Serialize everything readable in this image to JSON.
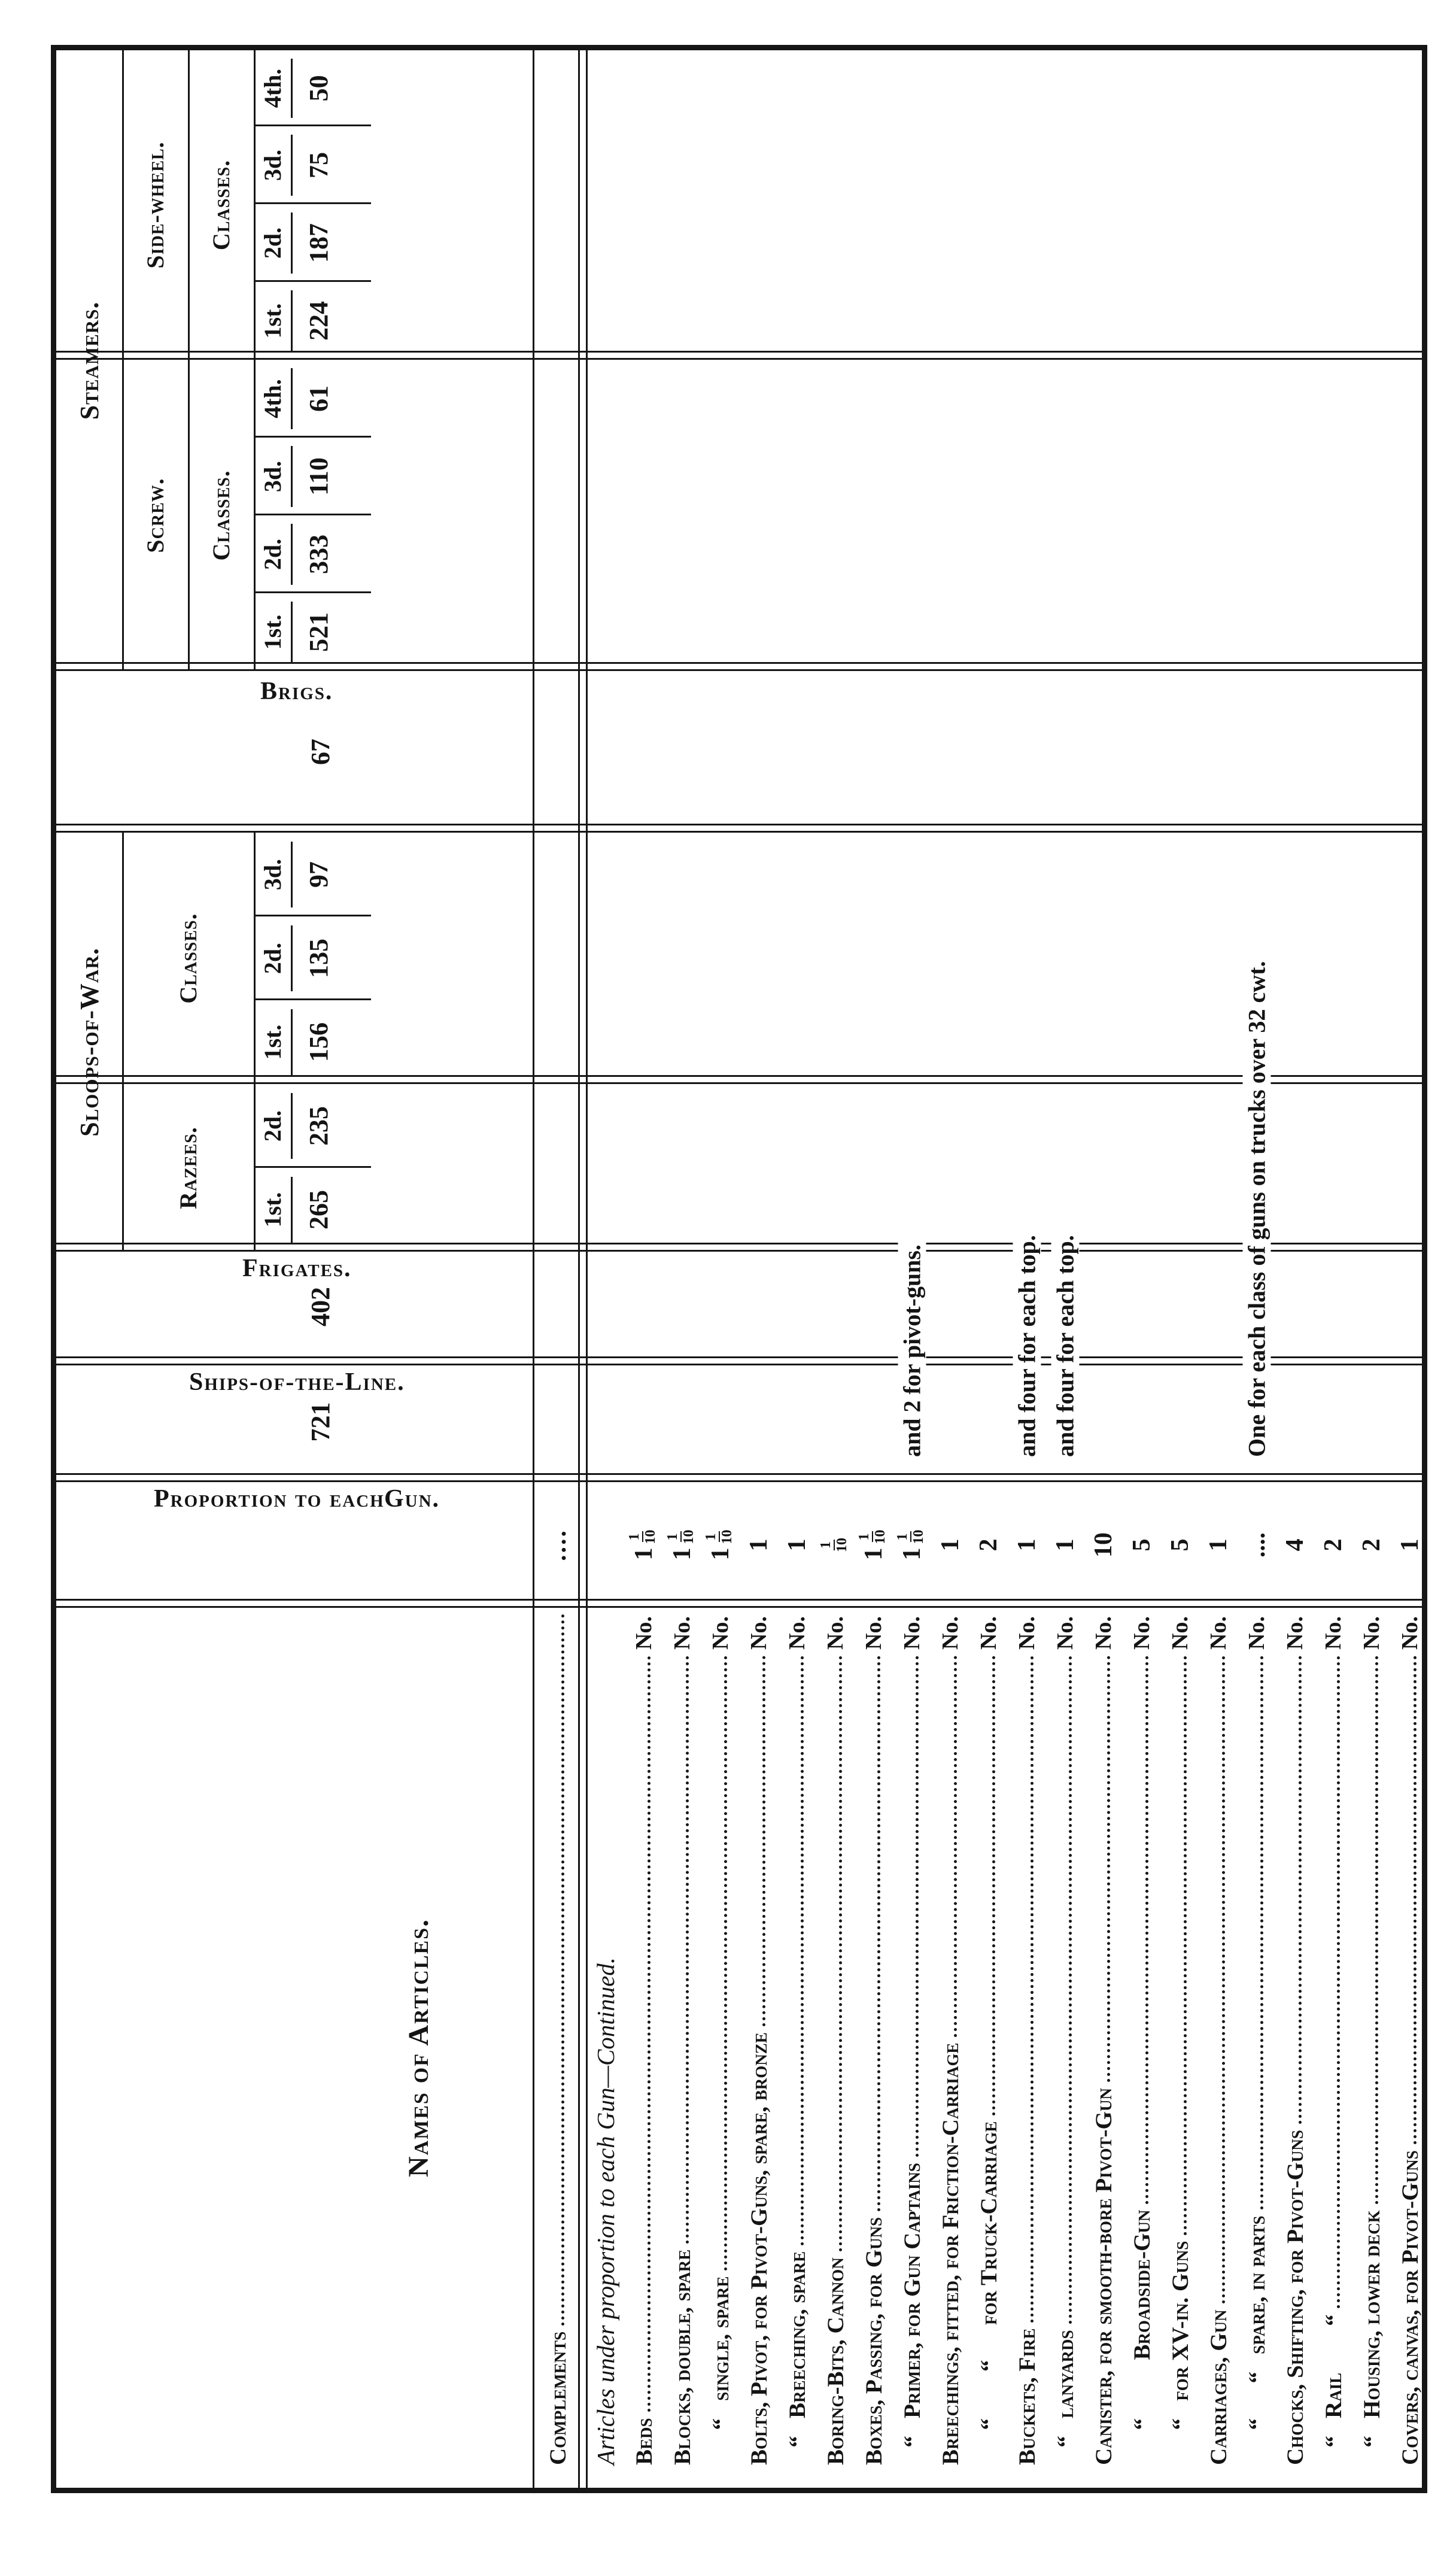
{
  "table": {
    "names_header": "Names of Articles.",
    "proportion": {
      "label1": "Proportion to each",
      "label2": "Gun.",
      "value_dots": "...."
    },
    "ships_of_the_line": {
      "label": "Ships-of-the-Line.",
      "complement": "721"
    },
    "frigates": {
      "label": "Frigates.",
      "complement": "402"
    },
    "sloops": {
      "label": "Sloops-of-War.",
      "razees": {
        "label": "Razees.",
        "cols": [
          {
            "label": "1st.",
            "complement": "265"
          },
          {
            "label": "2d.",
            "complement": "235"
          }
        ]
      },
      "classes": {
        "label": "Classes.",
        "cols": [
          {
            "label": "1st.",
            "complement": "156"
          },
          {
            "label": "2d.",
            "complement": "135"
          },
          {
            "label": "3d.",
            "complement": "97"
          }
        ]
      }
    },
    "brigs": {
      "label": "Brigs.",
      "complement": "67"
    },
    "steamers": {
      "label": "Steamers.",
      "screw": {
        "label": "Screw.",
        "classes_label": "Classes.",
        "cols": [
          {
            "label": "1st.",
            "complement": "521"
          },
          {
            "label": "2d.",
            "complement": "333"
          },
          {
            "label": "3d.",
            "complement": "110"
          },
          {
            "label": "4th.",
            "complement": "61"
          }
        ]
      },
      "side_wheel": {
        "label": "Side-wheel.",
        "classes_label": "Classes.",
        "cols": [
          {
            "label": "1st.",
            "complement": "224"
          },
          {
            "label": "2d.",
            "complement": "187"
          },
          {
            "label": "3d.",
            "complement": "75"
          },
          {
            "label": "4th.",
            "complement": "50"
          }
        ]
      }
    },
    "complements_row": {
      "label": "Complements",
      "value_dots": "...."
    },
    "rows": [
      {
        "style": "italic",
        "name": "Articles under proportion to each Gun—Continued."
      },
      {
        "name": "Beds",
        "no": "No.",
        "value": {
          "whole": "1",
          "num": "1",
          "den": "10"
        }
      },
      {
        "name": "Blocks, double, spare",
        "no": "No.",
        "value": {
          "whole": "1",
          "num": "1",
          "den": "10"
        }
      },
      {
        "name": "      “   single, spare",
        "no": "No.",
        "value": {
          "whole": "1",
          "num": "1",
          "den": "10"
        }
      },
      {
        "name": "Bolts, Pivot, for Pivot-Guns, spare, bronze",
        "no": "No.",
        "value": {
          "whole": "1"
        }
      },
      {
        "name": "   “   Breeching, spare",
        "no": "No.",
        "value": {
          "whole": "1"
        }
      },
      {
        "name": "Boring-Bits, Cannon",
        "no": "No.",
        "value": {
          "num": "1",
          "den": "10"
        }
      },
      {
        "name": "Boxes, Passing, for Guns",
        "no": "No.",
        "value": {
          "whole": "1",
          "num": "1",
          "den": "10"
        }
      },
      {
        "name": "   “   Primer, for Gun Captains",
        "no": "No.",
        "value": {
          "whole": "1",
          "num": "1",
          "den": "10"
        },
        "note": "and 2 for pivot-guns."
      },
      {
        "name": "Breechings, fitted, for Friction-Carriage",
        "no": "No.",
        "value": {
          "whole": "1"
        }
      },
      {
        "name": "      “        “      for Truck-Carriage",
        "no": "No.",
        "value": {
          "whole": "2"
        }
      },
      {
        "name": "Buckets, Fire",
        "no": "No.",
        "value": {
          "whole": "1"
        },
        "note": "and four for each top."
      },
      {
        "name": "   “   lanyards",
        "no": "No.",
        "value": {
          "whole": "1"
        },
        "note": "and four for each top."
      },
      {
        "name": "Canister, for smooth-bore Pivot-Gun",
        "no": "No.",
        "value": {
          "whole": "10"
        }
      },
      {
        "name": "      “          Broadside-Gun",
        "no": "No.",
        "value": {
          "whole": "5"
        }
      },
      {
        "name": "      “   for XV-in. Guns",
        "no": "No.",
        "value": {
          "whole": "5"
        }
      },
      {
        "name": "Carriages, Gun",
        "no": "No.",
        "value": {
          "whole": "1"
        }
      },
      {
        "name": "      “      “   spare, in parts",
        "no": "No.",
        "value": {
          "dots": "...."
        },
        "note": "One for each class of guns on trucks over 32 cwt."
      },
      {
        "name": "Chocks, Shifting, for Pivot-Guns",
        "no": "No.",
        "value": {
          "whole": "4"
        }
      },
      {
        "name": "   “   Rail        “",
        "no": "No.",
        "value": {
          "whole": "2"
        }
      },
      {
        "name": "   “   Housing, lower deck",
        "no": "No.",
        "value": {
          "whole": "2"
        }
      },
      {
        "name": "Covers, canvas, for Pivot-Guns",
        "no": "No.",
        "value": {
          "whole": "1"
        }
      }
    ]
  }
}
